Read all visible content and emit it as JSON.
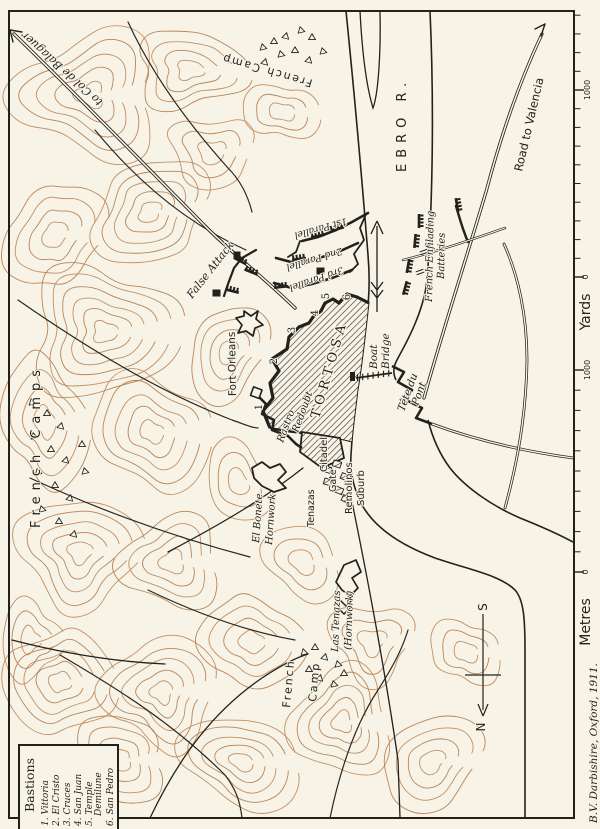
{
  "map": {
    "credit": "B.V. Darbishire, Oxford, 1911.",
    "city": {
      "name": "TORTOSA",
      "bastion_numbers": [
        "1",
        "2",
        "3",
        "4",
        "5",
        "6"
      ]
    },
    "legend": {
      "title": "Bastions",
      "lines": [
        "1. Vittoria",
        "2. El Cristo",
        "3. Cruces",
        "4. San Juan",
        "5. Temple",
        "Demilune",
        "6. San Pedro"
      ]
    },
    "scales": {
      "yards": {
        "label": "Yards",
        "min": "0",
        "max": "1000"
      },
      "metres": {
        "label": "Metres",
        "min": "0",
        "max": "1000"
      }
    },
    "compass": {
      "north": "N",
      "south": "S"
    },
    "river": {
      "name": "EBRO  R."
    },
    "roads": {
      "balaguer": "to Col de Balaguer",
      "valencia": "Road to Valencia"
    },
    "camps": {
      "north": "French Camp",
      "west": "French Camps",
      "south": [
        "French",
        "Camp"
      ]
    },
    "siege": {
      "parallel1": "1st Parallel",
      "parallel2": "2nd Parallel",
      "parallel3": "3rd Parallel",
      "false_attack": "False Attack",
      "enfilading": [
        "French Enfilading",
        "Batteries"
      ]
    },
    "features": {
      "fort_orleans": "Fort Orleans",
      "boat_bridge": [
        "Boat",
        "Bridge"
      ],
      "tete_du_pont": [
        "Tête du",
        "Pont"
      ],
      "rastro": [
        "Rastro",
        "Redoubt"
      ],
      "citadel": "Citadel",
      "tenazas_gate": [
        "Tenazas",
        "Gate"
      ],
      "remolinos": [
        "Remolinos",
        "Suburb"
      ],
      "el_bonete": [
        "El Bonete",
        "Hornwork"
      ],
      "las_tenazas": [
        "Las Tenazas",
        "(Hornwork)"
      ]
    },
    "colors": {
      "paper": "#f7f3e6",
      "ink": "#23211c",
      "contour": "#c08a5e"
    }
  }
}
